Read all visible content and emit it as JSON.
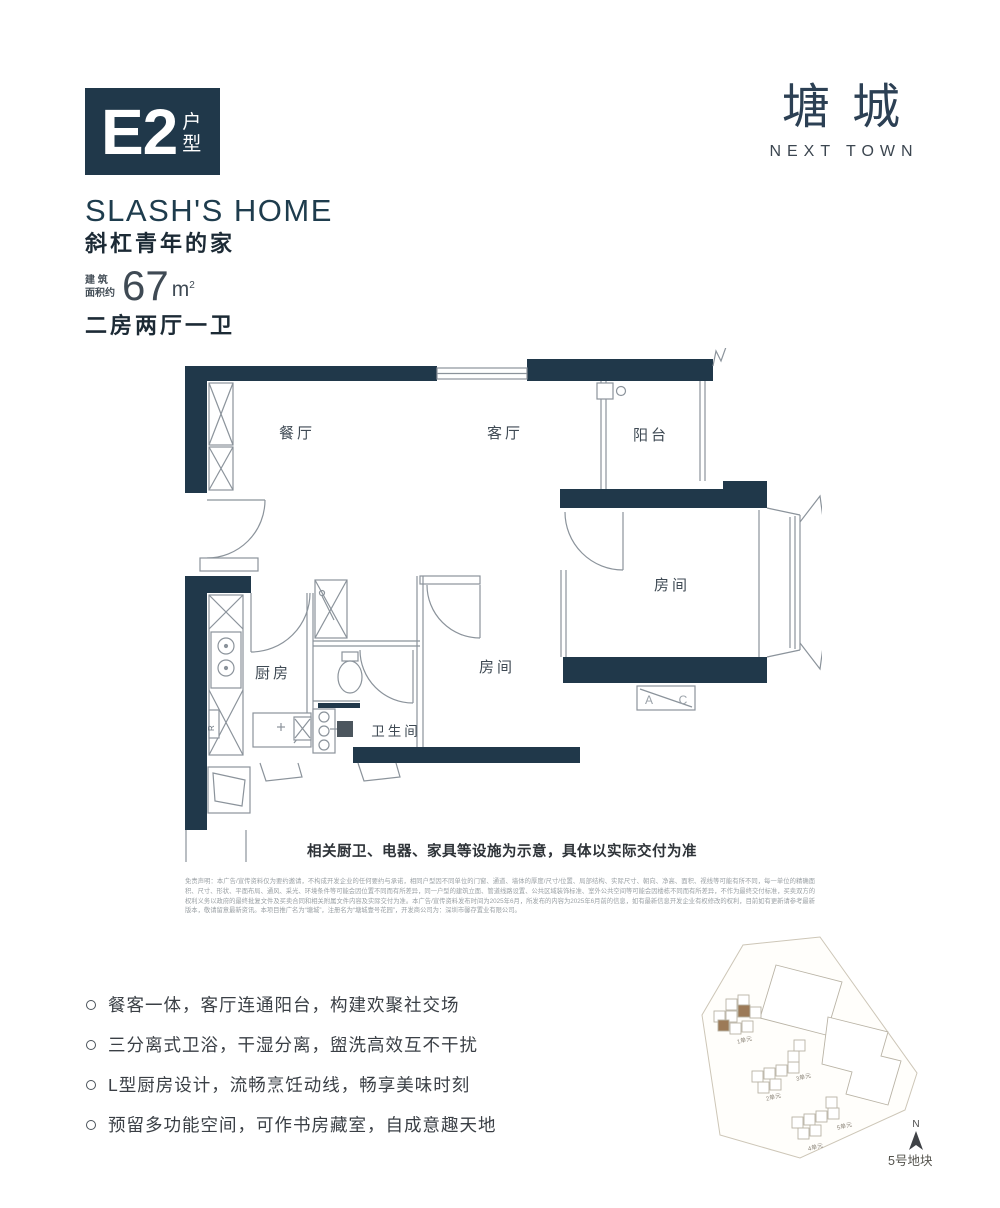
{
  "colors": {
    "wall_navy": "#20384a",
    "site_highlight": "#9c7a58"
  },
  "header": {
    "unit_badge": {
      "code": "E2",
      "suffix": "户型"
    },
    "logo": {
      "cn": "塘城",
      "en": "NEXT TOWN"
    }
  },
  "intro": {
    "title_en": "SLASH'S HOME",
    "title_cn": "斜杠青年的家",
    "area_label_line1": "建 筑",
    "area_label_line2": "面积约",
    "area_value": "67",
    "area_unit": "m",
    "area_sup": "2",
    "layout": "二房两厅一卫"
  },
  "floorplan": {
    "rooms": {
      "dining": "餐厅",
      "living": "客厅",
      "balcony": "阳台",
      "bedroom_master": "房间",
      "bedroom_second": "房间",
      "kitchen": "厨房",
      "bathroom": "卫生间"
    },
    "ac_a": "A",
    "ac_c": "C",
    "shaft_letter": "R",
    "caption": "相关厨卫、电器、家具等设施为示意，具体以实际交付为准"
  },
  "disclaimer": "免责声明：本广告/宣传资料仅为要约邀请，不构成开发企业的任何要约与承诺，相同户型因不同单位的门窗、通道、墙体的厚度/尺寸/位置、局部结构、实际尺寸、朝向、净高、面积、视线等可能有所不同，每一单位的精确面积、尺寸、形状、平面布局、通风、采光、环境条件等可能会因位置不同而有所差异，同一户型的建筑立面、管道线路设置、公共区域装饰标准、室外公共空间等可能会因楼栋不同而有所差异，不作为最终交付标准，买卖双方的权利义务以政府的最终批复文件及买卖合同和相关附属文件内容及实际交付为准。本广告/宣传资料发布时间为2025年6月，所发布的内容为2025年6月前的信息，如有最新信息开发企业有权修改的权利，目前如有更新请参考最新版本，敬请留意最新资讯。本项目推广名为“塘城”，注册名为“塘城壹号花园”，开发商公司为：深圳市馨存置业有限公司。",
  "highlights": [
    "餐客一体，客厅连通阳台，构建欢聚社交场",
    "三分离式卫浴，干湿分离，盥洗高效互不干扰",
    "L型厨房设计，流畅烹饪动线，畅享美味时刻",
    "预留多功能空间，可作书房藏室，自成意趣天地"
  ],
  "siteplan": {
    "units": [
      "1单元",
      "2单元",
      "3单元",
      "4单元",
      "5单元"
    ],
    "compass": "N",
    "plot_label": "5号地块"
  }
}
